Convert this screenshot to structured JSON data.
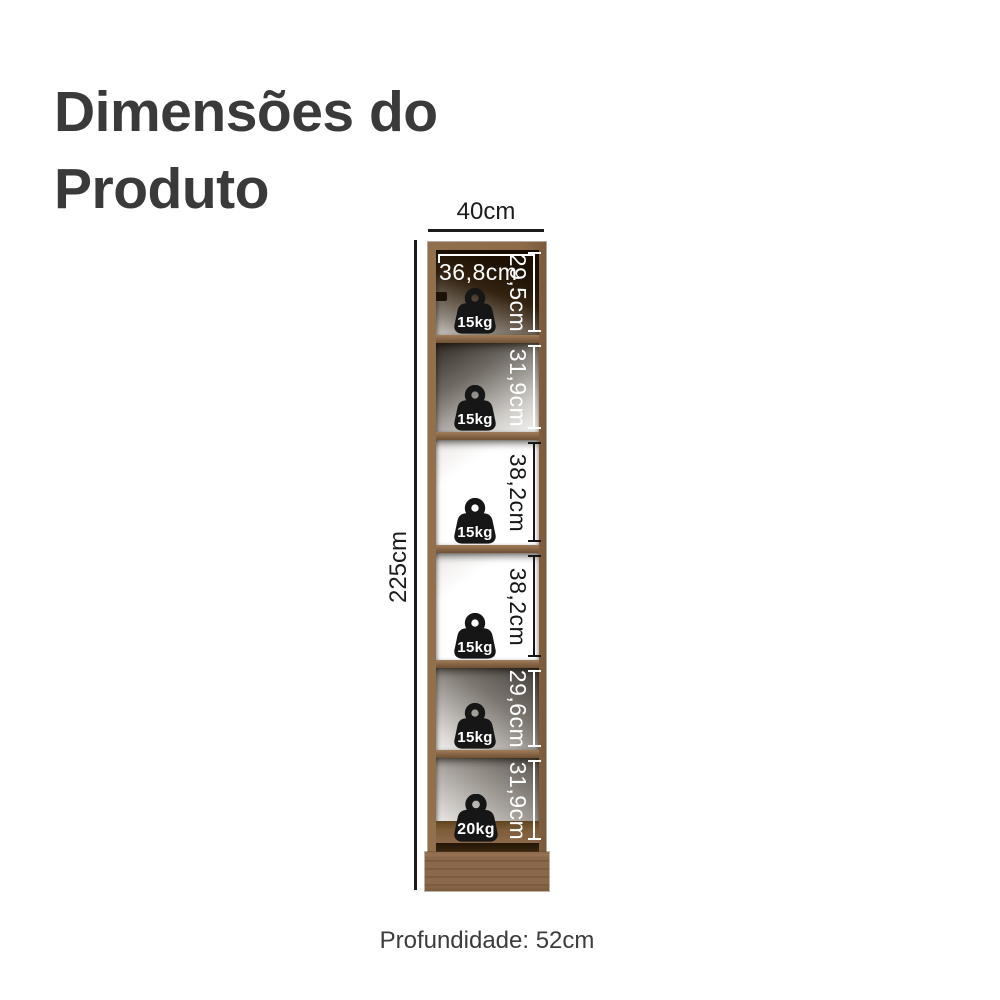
{
  "title": {
    "line1": "Dimensões do",
    "line2": "Produto"
  },
  "dimensions": {
    "width": "40cm",
    "height": "225cm",
    "inner_width": "36,8cm",
    "depth": "Profundidade: 52cm"
  },
  "compartments": [
    {
      "height": "29,5cm",
      "weight": "15kg"
    },
    {
      "height": "31,9cm",
      "weight": "15kg"
    },
    {
      "height": "38,2cm",
      "weight": "15kg"
    },
    {
      "height": "38,2cm",
      "weight": "15kg"
    },
    {
      "height": "29,6cm",
      "weight": "15kg"
    },
    {
      "height": "31,9cm",
      "weight": "20kg"
    }
  ],
  "icons": {
    "weight": "weight-icon"
  },
  "colors": {
    "wood": "#8d6b49",
    "wood_dark": "#6f5233",
    "measure_line": "#1b1b1b",
    "title_text": "#3a3a3a",
    "depth_text": "#3c3c3c",
    "weight_icon": "#161616",
    "background": "#ffffff"
  }
}
